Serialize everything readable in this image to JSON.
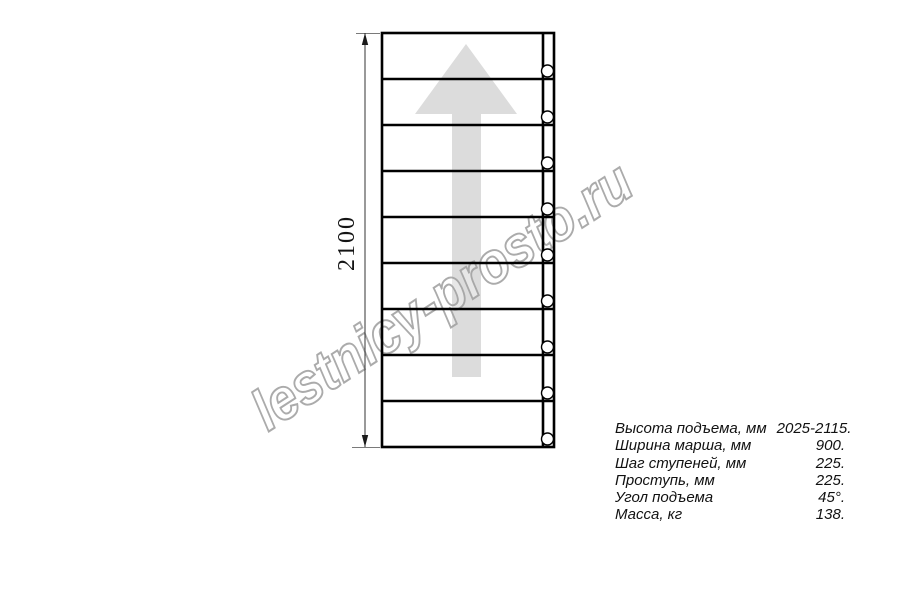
{
  "watermark": {
    "text": "lestnicy-prosto.ru"
  },
  "diagram": {
    "height_label": "2100",
    "steps": 9
  },
  "specs": {
    "rows": [
      {
        "label": "Высота подъема, мм",
        "value": "2025-2115."
      },
      {
        "label": "Ширина марша, мм",
        "value": "900."
      },
      {
        "label": "Шаг ступеней, мм",
        "value": "225."
      },
      {
        "label": "Проступь, мм",
        "value": "225."
      },
      {
        "label": "Угол подъема",
        "value": "45°."
      },
      {
        "label": "Масса, кг",
        "value": "138."
      }
    ]
  },
  "colors": {
    "line": "#000000",
    "arrow_fill": "#dcdcdc",
    "watermark": "#a3a3a3"
  }
}
